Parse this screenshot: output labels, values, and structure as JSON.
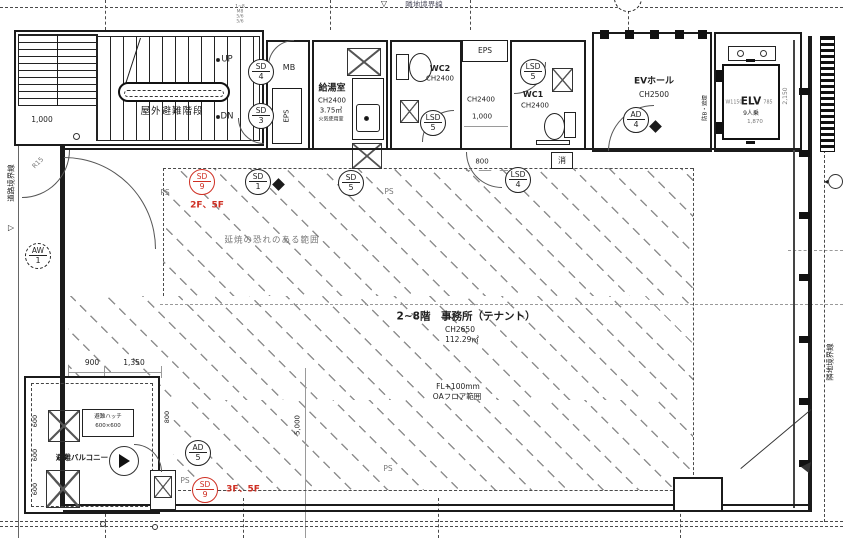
{
  "colors": {
    "ink": "#1b1b1b",
    "gray": "#787878",
    "red": "#cf2f23",
    "hatch": "#8f8f8f"
  },
  "stair": {
    "label": "屋外避難階段",
    "up": "UP",
    "dn": "DN",
    "dim": "1,000",
    "r15": "R15",
    "notes": [
      "1~8",
      "M8",
      "5/6",
      "5/6"
    ]
  },
  "top_rooms": {
    "mb": "MB",
    "eps_side": "EPS",
    "kitchen": {
      "name": "給湯室",
      "ch": "CH2400",
      "area": "3.75㎡",
      "note": "火気使用室"
    },
    "wc2": {
      "name": "WC2",
      "ch": "CH2400"
    },
    "eps_top": "EPS",
    "corridor": {
      "ch": "CH2400",
      "dim_w": "1,000",
      "dim_door": "800"
    },
    "wc1": {
      "name": "WC1",
      "ch": "CH2400"
    },
    "extinguisher": "消",
    "ev_hall": {
      "name": "EVホール",
      "ch": "CH2500"
    },
    "elv": {
      "name": "ELV",
      "w": "W1150",
      "d": "785",
      "cap": "9人乗",
      "dim": "1,870",
      "dim_v": "2,150",
      "smoke": "防B・遮煙"
    }
  },
  "office": {
    "title": "2~8階　事務所（テナント）",
    "ch": "CH2650",
    "area": "112.29㎡",
    "floor": "FL+100mm",
    "oa": "OAフロア範囲",
    "fire_note": "延焼の恐れのある範囲",
    "dim_v": "5,000"
  },
  "balcony": {
    "name": "避難バルコニー",
    "hatch": "避難ハッチ",
    "hatch_size": "600×600",
    "dim_w1": "900",
    "dim_w2": "1,350",
    "dim_h": "600",
    "dim_door": "800"
  },
  "markers": {
    "sd4": {
      "t": "SD",
      "n": "4"
    },
    "sd3": {
      "t": "SD",
      "n": "3"
    },
    "sd1": {
      "t": "SD",
      "n": "1"
    },
    "sd5": {
      "t": "SD",
      "n": "5"
    },
    "sd9a": {
      "t": "SD",
      "n": "9"
    },
    "sd9b": {
      "t": "SD",
      "n": "9"
    },
    "lsd5a": {
      "t": "LSD",
      "n": "5"
    },
    "lsd5b": {
      "t": "LSD",
      "n": "5"
    },
    "lsd4": {
      "t": "LSD",
      "n": "4"
    },
    "ad4": {
      "t": "AD",
      "n": "4"
    },
    "ad5": {
      "t": "AD",
      "n": "5"
    },
    "aw1": {
      "t": "AW",
      "n": "1"
    }
  },
  "red_notes": {
    "a": "2F、5F",
    "b": "3F、5F"
  },
  "ps": "PS",
  "boundaries": {
    "road": "道路境界線",
    "adjacent_top": "隣地境界線",
    "adjacent_right": "隣地境界線"
  }
}
